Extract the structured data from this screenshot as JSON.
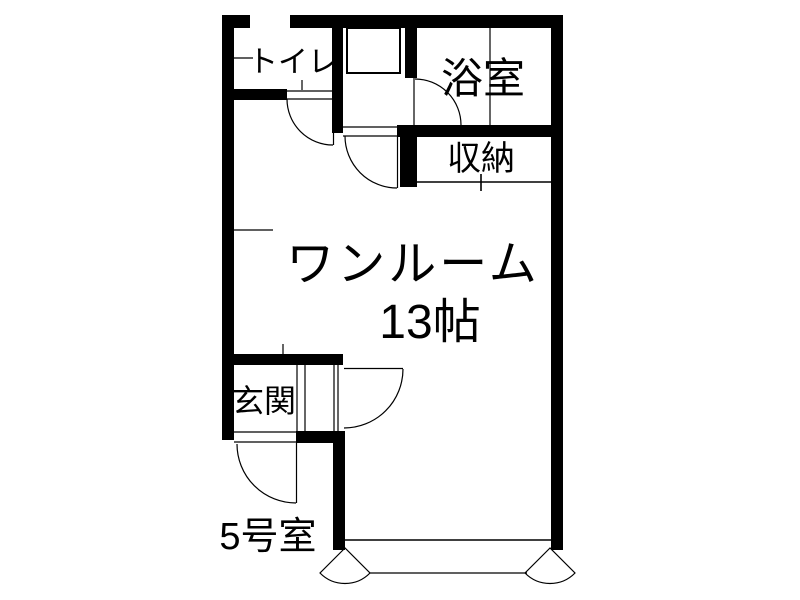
{
  "floorplan": {
    "unit_label": "5号室",
    "rooms": {
      "toilet": "トイレ",
      "bath": "浴室",
      "storage": "収納",
      "main_line1": "ワンルーム",
      "main_line2": "13帖",
      "entrance": "玄関"
    },
    "colors": {
      "wall": "#000000",
      "background": "#ffffff",
      "text": "#000000"
    }
  }
}
